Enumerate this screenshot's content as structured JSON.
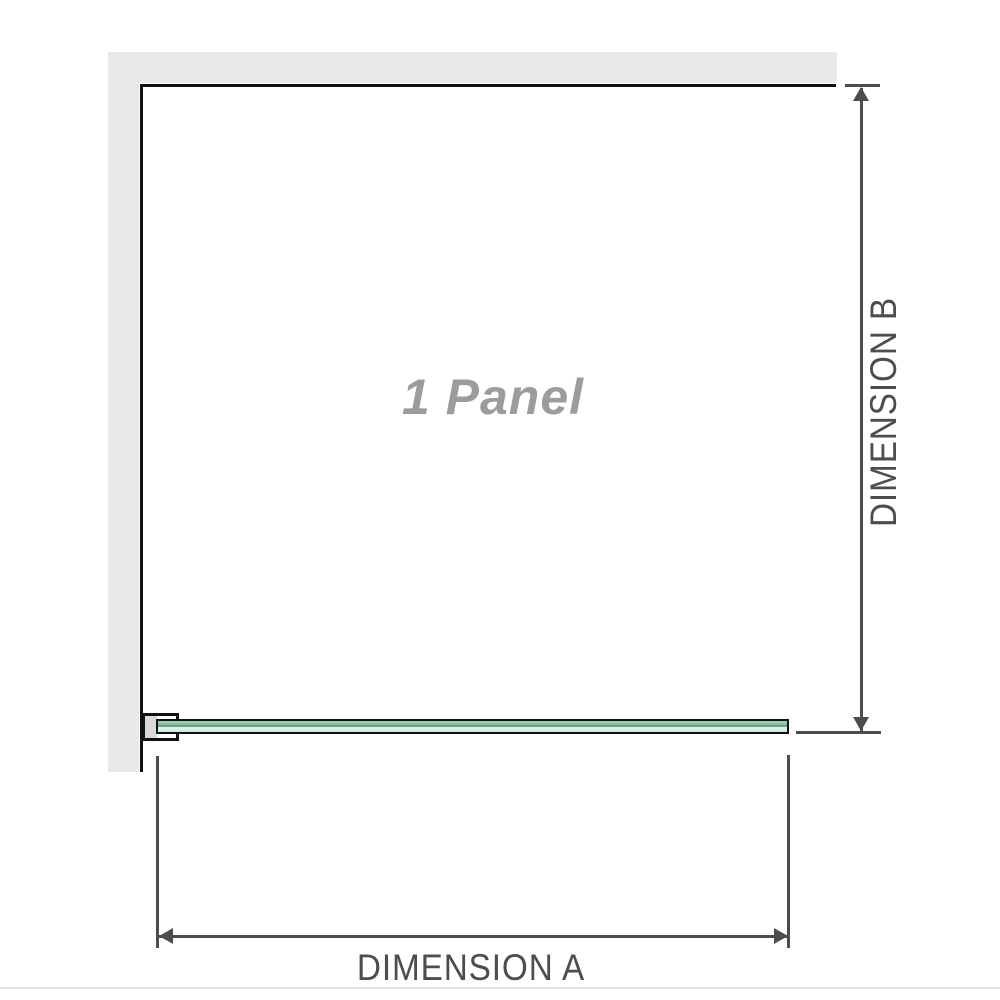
{
  "diagram": {
    "panel_label": "1 Panel",
    "dimensions": {
      "a_label": "DIMENSION A",
      "b_label": "DIMENSION B"
    },
    "colors": {
      "wall_fill": "#e9e9e9",
      "frame_outline": "#111111",
      "dimension_lines_and_text": "#4d4d4d",
      "panel_label_text": "#9c9c9c",
      "glass_green_dark": "#84c5a2",
      "glass_green_light": "#e2f5ea",
      "bracket_pad_fill": "#d9d9d9",
      "bottom_divider": "#e4e4e0"
    }
  }
}
